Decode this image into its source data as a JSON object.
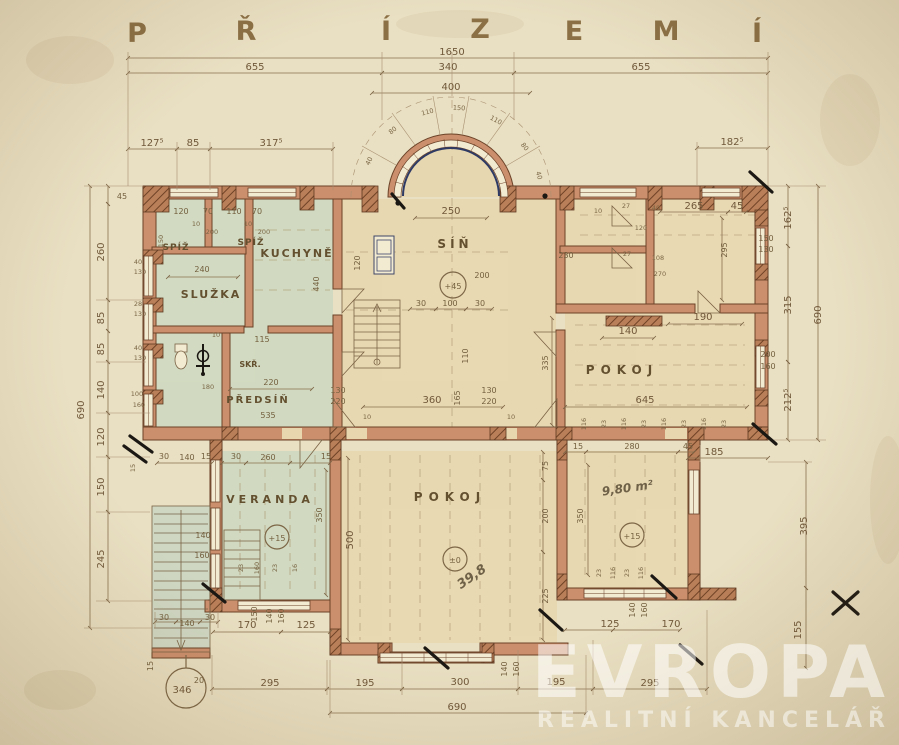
{
  "title": {
    "letters": [
      "P",
      "Ř",
      "Í",
      "Z",
      "E",
      "M",
      "Í"
    ]
  },
  "watermark": {
    "brand": "EVROPA",
    "subtitle": "REALITNÍ KANCELÁŘ"
  },
  "rooms": {
    "spiz_left": "SPÍŽ",
    "spiz_right": "SPÍŽ",
    "kuchyne": "KUCHYNĚ",
    "sluzka": "SLUŽKA",
    "sin": "SÍŇ",
    "skrin": "SKŘ.",
    "predsin": "PŘEDSÍŇ",
    "pokoj_east": "POKOJ",
    "pokoj_south": "POKOJ",
    "veranda": "VERANDA",
    "area_pokoj_south": "39,8",
    "area_room_east_small": "9,80 m²"
  },
  "levels": {
    "sin": "+45",
    "veranda": "+15",
    "room_980": "+15",
    "pokoj_south": "±0"
  },
  "stair_note": {
    "steps": "346",
    "riser": "20"
  },
  "dims": {
    "top": [
      "1650",
      "655",
      "340",
      "400",
      "655",
      "127⁵",
      "85",
      "317⁵",
      "182⁵",
      "250"
    ],
    "bay": [
      "40",
      "80",
      "110",
      "150",
      "110",
      "80",
      "40"
    ],
    "left": [
      "45",
      "260",
      "85",
      "85",
      "140",
      "120",
      "150",
      "245",
      "690",
      "40",
      "130",
      "28",
      "130",
      "40",
      "130",
      "100",
      "160",
      "15"
    ],
    "right": [
      "162⁵",
      "150",
      "130",
      "315",
      "200",
      "160",
      "212⁵",
      "690",
      "395",
      "155",
      "185"
    ],
    "bottom": [
      "30",
      "140",
      "30",
      "15",
      "150",
      "140",
      "160",
      "170",
      "125",
      "140",
      "160",
      "125",
      "170",
      "140",
      "160",
      "295",
      "195",
      "300",
      "195",
      "295",
      "690"
    ],
    "upper_left": [
      "120",
      "70",
      "110",
      "70",
      "10",
      "200",
      "10",
      "200",
      "240",
      "440",
      "10",
      "115",
      "220",
      "535",
      "180",
      "150"
    ],
    "center": [
      "200",
      "30",
      "100",
      "30",
      "120",
      "360",
      "130",
      "220",
      "130",
      "220",
      "10",
      "10",
      "110",
      "165"
    ],
    "upper_right": [
      "10",
      "27",
      "40",
      "120",
      "27",
      "108",
      "270",
      "265",
      "45",
      "230",
      "295",
      "190",
      "140",
      "645",
      "335"
    ],
    "lower": [
      "30",
      "140",
      "15",
      "30",
      "260",
      "15",
      "350",
      "140",
      "160",
      "500",
      "75",
      "200",
      "225",
      "15",
      "280",
      "45",
      "350",
      "23",
      "160",
      "23",
      "16"
    ],
    "mullions_east": [
      "116",
      "23",
      "116",
      "23",
      "116",
      "23",
      "116",
      "23"
    ],
    "mullions_south": [
      "23",
      "116",
      "23",
      "116"
    ]
  }
}
